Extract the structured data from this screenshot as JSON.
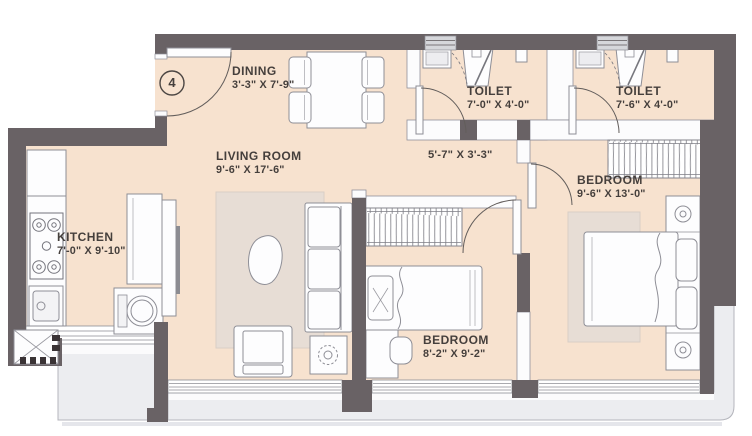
{
  "unit_number": "4",
  "rooms": {
    "dining": {
      "name": "DINING",
      "dims": "3'-3\" X 7'-9\""
    },
    "living": {
      "name": "LIVING ROOM",
      "dims": "9'-6\" X 17'-6\""
    },
    "kitchen": {
      "name": "KITCHEN",
      "dims": "7'-0\" X 9'-10\""
    },
    "toilet1": {
      "name": "TOILET",
      "dims": "7'-0\" X 4'-0\""
    },
    "toilet2": {
      "name": "TOILET",
      "dims": "7'-6\" X 4'-0\""
    },
    "passage": {
      "dims": "5'-7\" X 3'-3\""
    },
    "bedroom1": {
      "name": "BEDROOM",
      "dims": "8'-2\" X 9'-2\""
    },
    "bedroom2": {
      "name": "BEDROOM",
      "dims": "9'-6\" X 13'-0\""
    }
  },
  "colors": {
    "floor": "#f7e2cf",
    "wall": "#696265",
    "balcony": "#ecedf0",
    "rug": "#e7ddd5",
    "furniture_outline": "#8e8e96",
    "text": "#453f3c"
  }
}
